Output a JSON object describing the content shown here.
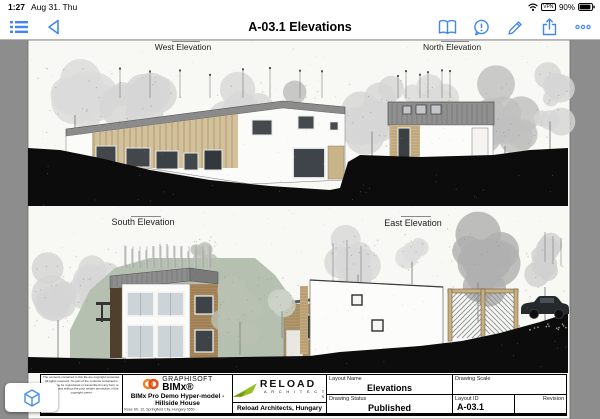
{
  "status_bar": {
    "time": "1:27",
    "date": "Aug 31. Thu",
    "vpn_label": "VPN",
    "battery_percent": "90%"
  },
  "toolbar": {
    "title": "A-03.1 Elevations"
  },
  "sheet": {
    "titles": {
      "west": "West Elevation",
      "north": "North Elevation",
      "south": "South Elevation",
      "east": "East Elevation"
    }
  },
  "title_block": {
    "legal_text": "The contents contained in this file are copyright protected. All rights reserved. No part of the contents contained in this file may be reproduced or transmitted in any form or by any means without the prior written permission of the copyright owner.",
    "graphisoft": {
      "company": "GRAPHISOFT",
      "product": "BIMx®",
      "project": "BIMx Pro Demo Hyper-model - Hillside House",
      "address": "Rose Str. 12, Springfield City, Hungary 5550"
    },
    "reload": {
      "wordmark": "RELOAD",
      "sub": "A R C H I T E C T S",
      "firm": "Reload Architects, Hungary"
    },
    "fields": {
      "layout_name_label": "Layout Name",
      "layout_name_value": "Elevations",
      "drawing_scale_label": "Drawing Scale",
      "drawing_scale_value": "",
      "drawing_status_label": "Drawing Status",
      "drawing_status_value": "Published",
      "layout_id_label": "Layout ID",
      "layout_id_value": "A-03.1",
      "revision_label": "Revision",
      "revision_value": ""
    }
  },
  "colors": {
    "accent_blue": "#3f87f5",
    "paper": "#f8f8f5",
    "app_bg": "#8d8d8d",
    "terrain_black": "#0c0c0c",
    "roof_gray": "#8d8d8d",
    "wood_tan": "#d2c19b",
    "wood_brown": "#a8885c",
    "hill_sage": "#b6c0b0",
    "logo_orange": "#f0821e",
    "logo_red": "#e8471f",
    "logo_green": "#96c120"
  }
}
